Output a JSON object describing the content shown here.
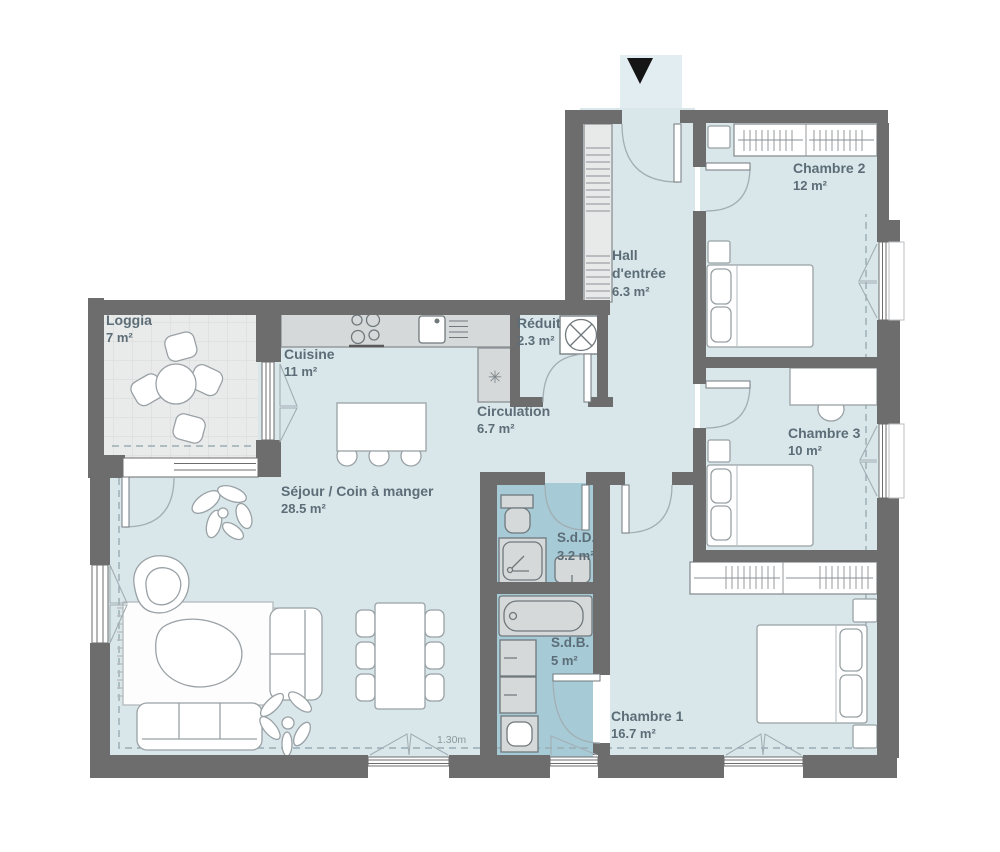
{
  "plan": {
    "title": "Apartment floor plan",
    "rooms": {
      "loggia": {
        "name": "Loggia",
        "area": "7 m²"
      },
      "cuisine": {
        "name": "Cuisine",
        "area": "11 m²"
      },
      "sejour": {
        "name": "Séjour / Coin à manger",
        "area": "28.5 m²"
      },
      "hall": {
        "name": "Hall d'entrée",
        "area": "6.3 m²"
      },
      "reduit": {
        "name": "Réduit",
        "area": "2.3 m²"
      },
      "circulation": {
        "name": "Circulation",
        "area": "6.7 m²"
      },
      "chambre2": {
        "name": "Chambre 2",
        "area": "12 m²"
      },
      "chambre3": {
        "name": "Chambre 3",
        "area": "10 m²"
      },
      "chambre1": {
        "name": "Chambre 1",
        "area": "16.7 m²"
      },
      "sdd": {
        "name": "S.d.D.",
        "area": "3.2 m²"
      },
      "sdb": {
        "name": "S.d.B.",
        "area": "5 m²"
      }
    },
    "annotations": {
      "ceiling_height": "1.30m"
    },
    "icons": {
      "entrance_arrow": "▼",
      "appliance": "✳"
    },
    "colors": {
      "wall": "#6d6d6d",
      "floor": "#d9e7ea",
      "wet_room_floor": "#a6cbd7",
      "loggia_floor": "#e9eaea",
      "entry_path": "#e1edf0",
      "furniture_stroke": "#99a1a5",
      "label_text": "#5c6d77"
    }
  }
}
